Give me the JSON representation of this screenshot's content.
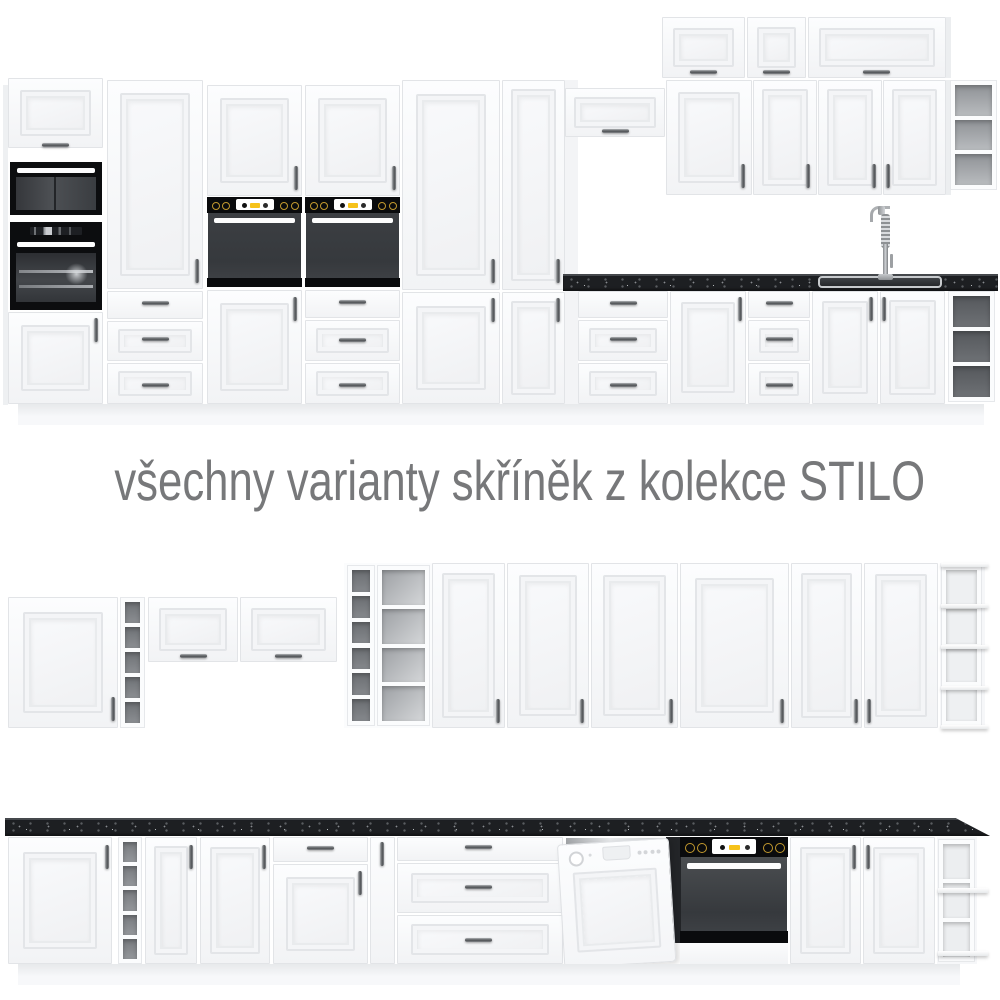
{
  "caption": {
    "text": "všechny varianty skříněk z kolekce STILO"
  },
  "collection_name": "STILO",
  "colors": {
    "background": "#ffffff",
    "cabinet_white": "#f6f7f9",
    "frame_line": "#e2e4e7",
    "countertop_black": "#1d1f22",
    "appliance_black": "#0a0b0d",
    "oven_door_gray": "#3c3f43",
    "accent_yellow": "#f6c21a",
    "knob_gold": "#c2992e",
    "caption_gray": "#77787a"
  },
  "scene": {
    "width": 1000,
    "height": 1000,
    "elements": [
      {
        "t": "panel",
        "n": "tall-run-side-panel",
        "x": 3,
        "y": 85,
        "w": 5,
        "h": 320,
        "c": "#eef0f2"
      },
      {
        "t": "flip",
        "n": "tall-cabinet-top-door",
        "x": 8,
        "y": 78,
        "w": 95,
        "h": 70
      },
      {
        "t": "hh",
        "n": "handle",
        "x": 42,
        "y": 143
      },
      {
        "t": "micro",
        "n": "microwave",
        "x": 10,
        "y": 162,
        "w": 92,
        "h": 53
      },
      {
        "t": "ovenL",
        "n": "built-in-oven",
        "x": 10,
        "y": 222,
        "w": 92,
        "h": 88
      },
      {
        "t": "door",
        "n": "cabinet-door",
        "x": 8,
        "y": 312,
        "w": 95,
        "h": 92
      },
      {
        "t": "hv",
        "n": "handle",
        "x": 94,
        "y": 318
      },
      {
        "t": "door",
        "n": "tall-cabinet-door",
        "x": 107,
        "y": 80,
        "w": 96,
        "h": 209
      },
      {
        "t": "hv",
        "n": "handle",
        "x": 195,
        "y": 259
      },
      {
        "t": "drawer",
        "n": "drawer",
        "x": 107,
        "y": 291,
        "w": 96,
        "h": 28
      },
      {
        "t": "hh",
        "n": "handle",
        "x": 142,
        "y": 301
      },
      {
        "t": "drawerF",
        "n": "drawer",
        "x": 107,
        "y": 321,
        "w": 96,
        "h": 40
      },
      {
        "t": "hh",
        "n": "handle",
        "x": 142,
        "y": 337
      },
      {
        "t": "drawerF",
        "n": "drawer",
        "x": 107,
        "y": 363,
        "w": 96,
        "h": 41
      },
      {
        "t": "hh",
        "n": "handle",
        "x": 142,
        "y": 383
      },
      {
        "t": "door",
        "n": "oven-housing-top-door",
        "x": 207,
        "y": 85,
        "w": 95,
        "h": 111
      },
      {
        "t": "hv",
        "n": "handle",
        "x": 294,
        "y": 166
      },
      {
        "t": "oven",
        "n": "built-in-oven",
        "x": 207,
        "y": 197,
        "w": 95,
        "h": 90,
        "o": {
          "p": 16,
          "s": 9,
          "dc": "#3c3f43"
        }
      },
      {
        "t": "door",
        "n": "cabinet-door",
        "x": 207,
        "y": 290,
        "w": 95,
        "h": 114
      },
      {
        "t": "hv",
        "n": "handle",
        "x": 293,
        "y": 297
      },
      {
        "t": "door",
        "n": "oven-housing-top-door",
        "x": 305,
        "y": 85,
        "w": 95,
        "h": 111
      },
      {
        "t": "hv",
        "n": "handle",
        "x": 392,
        "y": 166
      },
      {
        "t": "oven",
        "n": "built-in-oven",
        "x": 305,
        "y": 197,
        "w": 95,
        "h": 90,
        "o": {
          "p": 16,
          "s": 9,
          "dc": "#3c3f43"
        }
      },
      {
        "t": "drawer",
        "n": "drawer",
        "x": 305,
        "y": 290,
        "w": 95,
        "h": 28
      },
      {
        "t": "hh",
        "n": "handle",
        "x": 339,
        "y": 300
      },
      {
        "t": "drawerF",
        "n": "drawer",
        "x": 305,
        "y": 320,
        "w": 95,
        "h": 41
      },
      {
        "t": "hh",
        "n": "handle",
        "x": 339,
        "y": 338
      },
      {
        "t": "drawerF",
        "n": "drawer",
        "x": 305,
        "y": 363,
        "w": 95,
        "h": 41
      },
      {
        "t": "hh",
        "n": "handle",
        "x": 339,
        "y": 383
      },
      {
        "t": "door",
        "n": "tall-cabinet-door",
        "x": 402,
        "y": 80,
        "w": 98,
        "h": 210
      },
      {
        "t": "hv",
        "n": "handle",
        "x": 491,
        "y": 259
      },
      {
        "t": "door",
        "n": "cabinet-door",
        "x": 402,
        "y": 292,
        "w": 98,
        "h": 112
      },
      {
        "t": "hv",
        "n": "handle",
        "x": 491,
        "y": 298
      },
      {
        "t": "door",
        "n": "tall-cabinet-door",
        "x": 502,
        "y": 80,
        "w": 63,
        "h": 210
      },
      {
        "t": "hv",
        "n": "handle",
        "x": 556,
        "y": 259
      },
      {
        "t": "door",
        "n": "cabinet-door",
        "x": 502,
        "y": 292,
        "w": 63,
        "h": 112
      },
      {
        "t": "hv",
        "n": "handle",
        "x": 556,
        "y": 298
      },
      {
        "t": "panel",
        "n": "tall-run-end-panel",
        "x": 565,
        "y": 80,
        "w": 13,
        "h": 324,
        "c": "#f3f4f6"
      },
      {
        "t": "flip",
        "n": "wall-flip-door",
        "x": 662,
        "y": 17,
        "w": 83,
        "h": 61
      },
      {
        "t": "hh",
        "n": "handle",
        "x": 690,
        "y": 70
      },
      {
        "t": "flip",
        "n": "wall-flip-door",
        "x": 747,
        "y": 17,
        "w": 59,
        "h": 61
      },
      {
        "t": "hh",
        "n": "handle",
        "x": 763,
        "y": 70
      },
      {
        "t": "flip",
        "n": "wall-flip-door",
        "x": 808,
        "y": 17,
        "w": 138,
        "h": 61
      },
      {
        "t": "hh",
        "n": "handle",
        "x": 863,
        "y": 70
      },
      {
        "t": "panel",
        "n": "wall-side-panel",
        "x": 946,
        "y": 17,
        "w": 5,
        "h": 61,
        "c": "#eceef0"
      },
      {
        "t": "flip",
        "n": "wall-flip-door",
        "x": 565,
        "y": 88,
        "w": 100,
        "h": 49
      },
      {
        "t": "hh",
        "n": "handle",
        "x": 602,
        "y": 129
      },
      {
        "t": "door",
        "n": "wall-cabinet-door",
        "x": 666,
        "y": 80,
        "w": 86,
        "h": 115
      },
      {
        "t": "hv",
        "n": "handle",
        "x": 741,
        "y": 164
      },
      {
        "t": "door",
        "n": "wall-cabinet-door",
        "x": 753,
        "y": 80,
        "w": 64,
        "h": 115
      },
      {
        "t": "hv",
        "n": "handle",
        "x": 806,
        "y": 164
      },
      {
        "t": "door",
        "n": "wall-cabinet-door",
        "x": 818,
        "y": 80,
        "w": 64,
        "h": 115
      },
      {
        "t": "hv",
        "n": "handle",
        "x": 872,
        "y": 164
      },
      {
        "t": "door",
        "n": "wall-cabinet-door",
        "x": 883,
        "y": 80,
        "w": 63,
        "h": 115
      },
      {
        "t": "hv",
        "n": "handle",
        "x": 886,
        "y": 164
      },
      {
        "t": "panel",
        "n": "wall-side-panel",
        "x": 946,
        "y": 80,
        "w": 5,
        "h": 115,
        "c": "#eceef0"
      },
      {
        "t": "shelfcol",
        "n": "open-wall-shelf",
        "x": 950,
        "y": 80,
        "w": 47,
        "h": 110,
        "o": {
          "n": 3,
          "c": "linear-gradient(180deg,#8f9296,#b9bcbf)"
        }
      },
      {
        "t": "drawer",
        "n": "drawer",
        "x": 578,
        "y": 291,
        "w": 90,
        "h": 27
      },
      {
        "t": "hh",
        "n": "handle",
        "x": 610,
        "y": 301
      },
      {
        "t": "drawerF",
        "n": "drawer",
        "x": 578,
        "y": 320,
        "w": 90,
        "h": 41
      },
      {
        "t": "hh",
        "n": "handle",
        "x": 610,
        "y": 337
      },
      {
        "t": "drawerF",
        "n": "drawer",
        "x": 578,
        "y": 363,
        "w": 90,
        "h": 41
      },
      {
        "t": "hh",
        "n": "handle",
        "x": 610,
        "y": 383
      },
      {
        "t": "door",
        "n": "base-cabinet-door",
        "x": 670,
        "y": 291,
        "w": 76,
        "h": 113
      },
      {
        "t": "hv",
        "n": "handle",
        "x": 738,
        "y": 297
      },
      {
        "t": "drawer",
        "n": "drawer",
        "x": 748,
        "y": 291,
        "w": 62,
        "h": 27
      },
      {
        "t": "hh",
        "n": "handle",
        "x": 766,
        "y": 301
      },
      {
        "t": "drawerF",
        "n": "drawer",
        "x": 748,
        "y": 320,
        "w": 62,
        "h": 41
      },
      {
        "t": "hh",
        "n": "handle",
        "x": 766,
        "y": 337
      },
      {
        "t": "drawerF",
        "n": "drawer",
        "x": 748,
        "y": 363,
        "w": 62,
        "h": 41
      },
      {
        "t": "hh",
        "n": "handle",
        "x": 766,
        "y": 383
      },
      {
        "t": "door",
        "n": "sink-cabinet-door",
        "x": 812,
        "y": 291,
        "w": 66,
        "h": 113
      },
      {
        "t": "hv",
        "n": "handle",
        "x": 869,
        "y": 297
      },
      {
        "t": "door",
        "n": "sink-cabinet-door",
        "x": 880,
        "y": 291,
        "w": 65,
        "h": 113
      },
      {
        "t": "hv",
        "n": "handle",
        "x": 882,
        "y": 297
      },
      {
        "t": "shelfcol",
        "n": "open-base-shelf",
        "x": 948,
        "y": 291,
        "w": 47,
        "h": 111,
        "o": {
          "n": 3,
          "c": "linear-gradient(180deg,#55585c,#6e7175)"
        }
      },
      {
        "t": "plinth",
        "n": "plinth",
        "x": 18,
        "y": 404,
        "w": 966,
        "h": 21
      },
      {
        "t": "counter",
        "n": "countertop",
        "x": 563,
        "y": 274,
        "w": 435,
        "h": 17
      },
      {
        "t": "sink",
        "n": "sink",
        "x": 818,
        "y": 276,
        "w": 124,
        "h": 12
      },
      {
        "t": "faucet",
        "n": "faucet",
        "x": 866,
        "y": 206,
        "w": 36,
        "h": 74
      },
      {
        "t": "door",
        "n": "wall-cabinet-door",
        "x": 8,
        "y": 597,
        "w": 110,
        "h": 131
      },
      {
        "t": "hv",
        "n": "handle",
        "x": 111,
        "y": 697
      },
      {
        "t": "shelfcol",
        "n": "open-shelf-column",
        "x": 120,
        "y": 597,
        "w": 25,
        "h": 131,
        "o": {
          "n": 5,
          "c": "linear-gradient(180deg,#6e7175,#8b8e92)"
        }
      },
      {
        "t": "flip",
        "n": "wall-flip-door",
        "x": 148,
        "y": 597,
        "w": 90,
        "h": 65
      },
      {
        "t": "hh",
        "n": "handle",
        "x": 180,
        "y": 654
      },
      {
        "t": "flip",
        "n": "wall-flip-door",
        "x": 240,
        "y": 597,
        "w": 97,
        "h": 65
      },
      {
        "t": "hh",
        "n": "handle",
        "x": 275,
        "y": 654
      },
      {
        "t": "panel",
        "n": "tall-open-shelf-unit",
        "x": 344,
        "y": 563,
        "w": 88,
        "h": 165,
        "c": "#fbfcfd"
      },
      {
        "t": "shelfcol",
        "n": "shelf-cells",
        "x": 347,
        "y": 565,
        "w": 28,
        "h": 161,
        "o": {
          "n": 6,
          "c": "linear-gradient(180deg,#6b6e72,#85888c)"
        }
      },
      {
        "t": "shelfcol",
        "n": "shelf-cells",
        "x": 377,
        "y": 565,
        "w": 53,
        "h": 161,
        "o": {
          "n": 4,
          "c": "linear-gradient(135deg,#9da0a4,#d5d7d9)"
        }
      },
      {
        "t": "door",
        "n": "tall-cabinet-door",
        "x": 432,
        "y": 563,
        "w": 73,
        "h": 165
      },
      {
        "t": "hv",
        "n": "handle",
        "x": 496,
        "y": 699
      },
      {
        "t": "door",
        "n": "tall-cabinet-door",
        "x": 507,
        "y": 563,
        "w": 82,
        "h": 165
      },
      {
        "t": "hv",
        "n": "handle",
        "x": 580,
        "y": 699
      },
      {
        "t": "door",
        "n": "tall-cabinet-door",
        "x": 591,
        "y": 563,
        "w": 87,
        "h": 165
      },
      {
        "t": "hv",
        "n": "handle",
        "x": 669,
        "y": 699
      },
      {
        "t": "door",
        "n": "tall-cabinet-door",
        "x": 680,
        "y": 563,
        "w": 109,
        "h": 165
      },
      {
        "t": "hv",
        "n": "handle",
        "x": 780,
        "y": 699
      },
      {
        "t": "door",
        "n": "tall-cabinet-door",
        "x": 791,
        "y": 563,
        "w": 71,
        "h": 165
      },
      {
        "t": "hv",
        "n": "handle",
        "x": 854,
        "y": 699
      },
      {
        "t": "door",
        "n": "tall-cabinet-door",
        "x": 864,
        "y": 563,
        "w": 74,
        "h": 165
      },
      {
        "t": "hv",
        "n": "handle",
        "x": 867,
        "y": 699
      },
      {
        "t": "panel",
        "n": "open-end-unit",
        "x": 940,
        "y": 563,
        "w": 45,
        "h": 165,
        "c": "#f6f7f9"
      },
      {
        "t": "shelfcol",
        "n": "shelf-cells",
        "x": 941,
        "y": 565,
        "w": 41,
        "h": 161,
        "o": {
          "n": 4,
          "c": "#eef0f2"
        }
      },
      {
        "t": "board",
        "n": "shelf-board",
        "x": 941,
        "y": 563,
        "w": 47,
        "h": 4
      },
      {
        "t": "board",
        "n": "shelf-board",
        "x": 941,
        "y": 604,
        "w": 47,
        "h": 4
      },
      {
        "t": "board",
        "n": "shelf-board",
        "x": 941,
        "y": 645,
        "w": 47,
        "h": 4
      },
      {
        "t": "board",
        "n": "shelf-board",
        "x": 941,
        "y": 686,
        "w": 47,
        "h": 4
      },
      {
        "t": "board",
        "n": "shelf-board",
        "x": 941,
        "y": 725,
        "w": 47,
        "h": 4
      },
      {
        "t": "door",
        "n": "base-cabinet-door",
        "x": 8,
        "y": 837,
        "w": 104,
        "h": 127
      },
      {
        "t": "hv",
        "n": "handle",
        "x": 105,
        "y": 845
      },
      {
        "t": "shelfcol",
        "n": "open-shelf-column",
        "x": 118,
        "y": 837,
        "w": 24,
        "h": 127,
        "o": {
          "n": 5,
          "c": "linear-gradient(180deg,#787b7f,#94979b)"
        }
      },
      {
        "t": "door",
        "n": "base-cabinet-door",
        "x": 145,
        "y": 837,
        "w": 52,
        "h": 127
      },
      {
        "t": "hv",
        "n": "handle",
        "x": 189,
        "y": 845
      },
      {
        "t": "door",
        "n": "base-cabinet-door",
        "x": 200,
        "y": 837,
        "w": 70,
        "h": 127
      },
      {
        "t": "hv",
        "n": "handle",
        "x": 262,
        "y": 845
      },
      {
        "t": "drawer",
        "n": "drawer",
        "x": 273,
        "y": 837,
        "w": 95,
        "h": 25
      },
      {
        "t": "hh",
        "n": "handle",
        "x": 307,
        "y": 846
      },
      {
        "t": "door",
        "n": "base-cabinet-door",
        "x": 273,
        "y": 864,
        "w": 95,
        "h": 100
      },
      {
        "t": "hv",
        "n": "handle",
        "x": 358,
        "y": 871
      },
      {
        "t": "door",
        "n": "narrow-cabinet-door",
        "x": 370,
        "y": 837,
        "w": 25,
        "h": 127
      },
      {
        "t": "hv",
        "n": "handle",
        "x": 380,
        "y": 842
      },
      {
        "t": "drawer",
        "n": "drawer",
        "x": 397,
        "y": 837,
        "w": 166,
        "h": 24
      },
      {
        "t": "hh",
        "n": "handle",
        "x": 465,
        "y": 845
      },
      {
        "t": "drawerF",
        "n": "drawer",
        "x": 397,
        "y": 863,
        "w": 166,
        "h": 50
      },
      {
        "t": "hh",
        "n": "handle",
        "x": 465,
        "y": 885
      },
      {
        "t": "drawerF",
        "n": "drawer",
        "x": 397,
        "y": 915,
        "w": 166,
        "h": 49
      },
      {
        "t": "hh",
        "n": "handle",
        "x": 465,
        "y": 938
      },
      {
        "t": "panel",
        "n": "dishwasher-recess",
        "x": 566,
        "y": 838,
        "w": 106,
        "h": 28,
        "c": "linear-gradient(100deg,#9fa2a5,#e8eaec 40%,#c7cacd)"
      },
      {
        "t": "panel",
        "n": "oven-side-panel",
        "x": 666,
        "y": 837,
        "w": 18,
        "h": 106,
        "c": "#232528"
      },
      {
        "t": "dw",
        "n": "dishwasher",
        "x": 564,
        "y": 841,
        "w": 112,
        "h": 124
      },
      {
        "t": "oven",
        "n": "built-in-oven",
        "x": 680,
        "y": 837,
        "w": 108,
        "h": 106,
        "o": {
          "p": 20,
          "s": 12,
          "dc": "#4b4e51"
        }
      },
      {
        "t": "panel",
        "n": "oven-under-panel",
        "x": 680,
        "y": 943,
        "w": 108,
        "h": 21,
        "c": "linear-gradient(180deg,#fbfcfd,#f2f3f5)"
      },
      {
        "t": "door",
        "n": "base-cabinet-door",
        "x": 790,
        "y": 837,
        "w": 71,
        "h": 127
      },
      {
        "t": "hv",
        "n": "handle",
        "x": 852,
        "y": 845
      },
      {
        "t": "door",
        "n": "base-cabinet-door",
        "x": 863,
        "y": 837,
        "w": 72,
        "h": 127
      },
      {
        "t": "hv",
        "n": "handle",
        "x": 866,
        "y": 845
      },
      {
        "t": "panel",
        "n": "open-end-unit",
        "x": 937,
        "y": 837,
        "w": 40,
        "h": 127,
        "c": "#f6f7f9"
      },
      {
        "t": "shelfcol",
        "n": "shelf-cells",
        "x": 938,
        "y": 839,
        "w": 37,
        "h": 123,
        "o": {
          "n": 3,
          "c": "#eceef0"
        }
      },
      {
        "t": "board",
        "n": "shelf-board",
        "x": 938,
        "y": 888,
        "w": 50,
        "h": 5
      },
      {
        "t": "board",
        "n": "shelf-board",
        "x": 938,
        "y": 951,
        "w": 50,
        "h": 5
      },
      {
        "t": "plinth",
        "n": "plinth",
        "x": 18,
        "y": 964,
        "w": 942,
        "h": 21
      },
      {
        "t": "counter",
        "n": "countertop",
        "x": 5,
        "y": 818,
        "w": 985,
        "h": 18,
        "o": {
          "clip": "polygon(0 0, 96.5% 0, 100% 100%, 0 100%)"
        }
      }
    ]
  }
}
